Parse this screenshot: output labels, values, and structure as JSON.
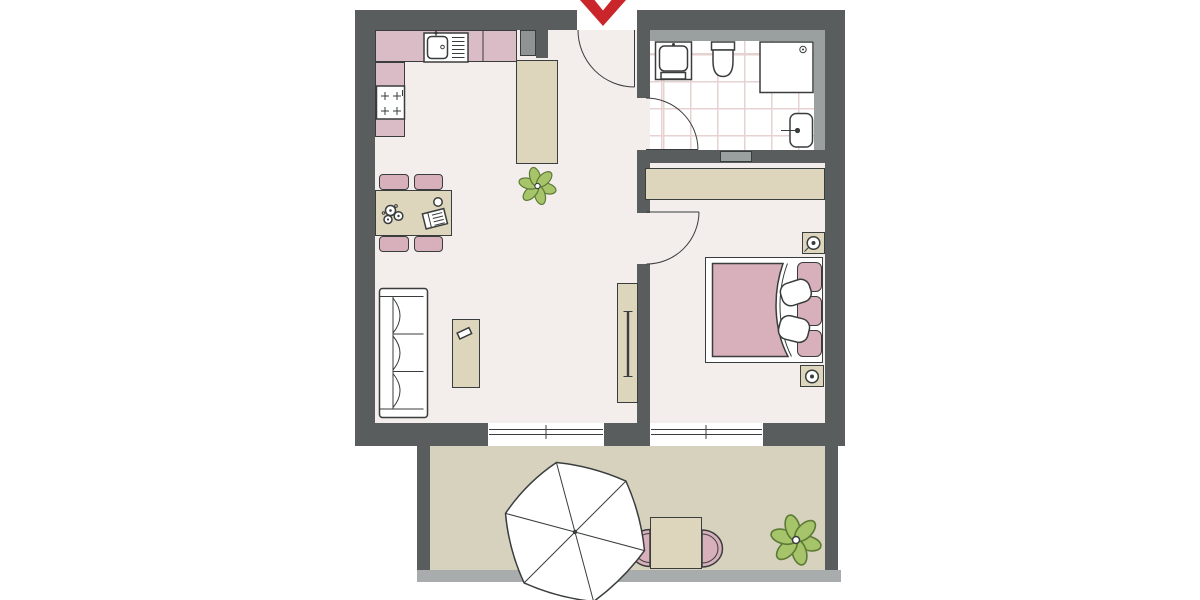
{
  "colors": {
    "paper": "#ffffff",
    "wall": "#595d5d",
    "wallLight": "#9aa0a0",
    "railing": "#a8acac",
    "shaft": "#8f9393",
    "floor": "#f3edeb",
    "terrace": "#d6d2bd",
    "tileLine": "#e7d2d2",
    "beige": "#ded5bd",
    "pink": "#d7b0bb",
    "counterPink": "#d9bcc5",
    "outline": "#3a3d3d",
    "green": "#a6c469",
    "greenStroke": "#5d7a36",
    "red": "#c9252b"
  },
  "plan": {
    "type": "apartment-floor-plan",
    "entrance_marker": "red-chevron-arrow",
    "rooms": [
      {
        "name": "kitchen-living-room",
        "items": [
          "kitchen-counter",
          "kitchen-sink",
          "stove",
          "utility-shaft",
          "entry-wardrobe",
          "dining-table",
          "dining-chairs-x4",
          "flower-vase",
          "plate",
          "book",
          "sofa",
          "coffee-table",
          "remote-control",
          "tv-sideboard",
          "tv",
          "houseplant"
        ]
      },
      {
        "name": "bathroom",
        "items": [
          "washbasin",
          "toilet",
          "shower",
          "towel-radiator",
          "wall-vent",
          "tiled-floor"
        ]
      },
      {
        "name": "bedroom",
        "items": [
          "wardrobe",
          "double-bed",
          "blanket",
          "pillows-x2",
          "headboard-cushions-x3",
          "nightstands-x2",
          "table-lamps-x2"
        ]
      },
      {
        "name": "terrace",
        "items": [
          "parasol-umbrella",
          "terrace-table",
          "terrace-chairs-x2",
          "houseplant",
          "railing"
        ]
      }
    ],
    "doors": [
      "entrance-door",
      "bathroom-door",
      "bedroom-door"
    ],
    "windows": [
      "living-room-window",
      "bedroom-window"
    ]
  }
}
